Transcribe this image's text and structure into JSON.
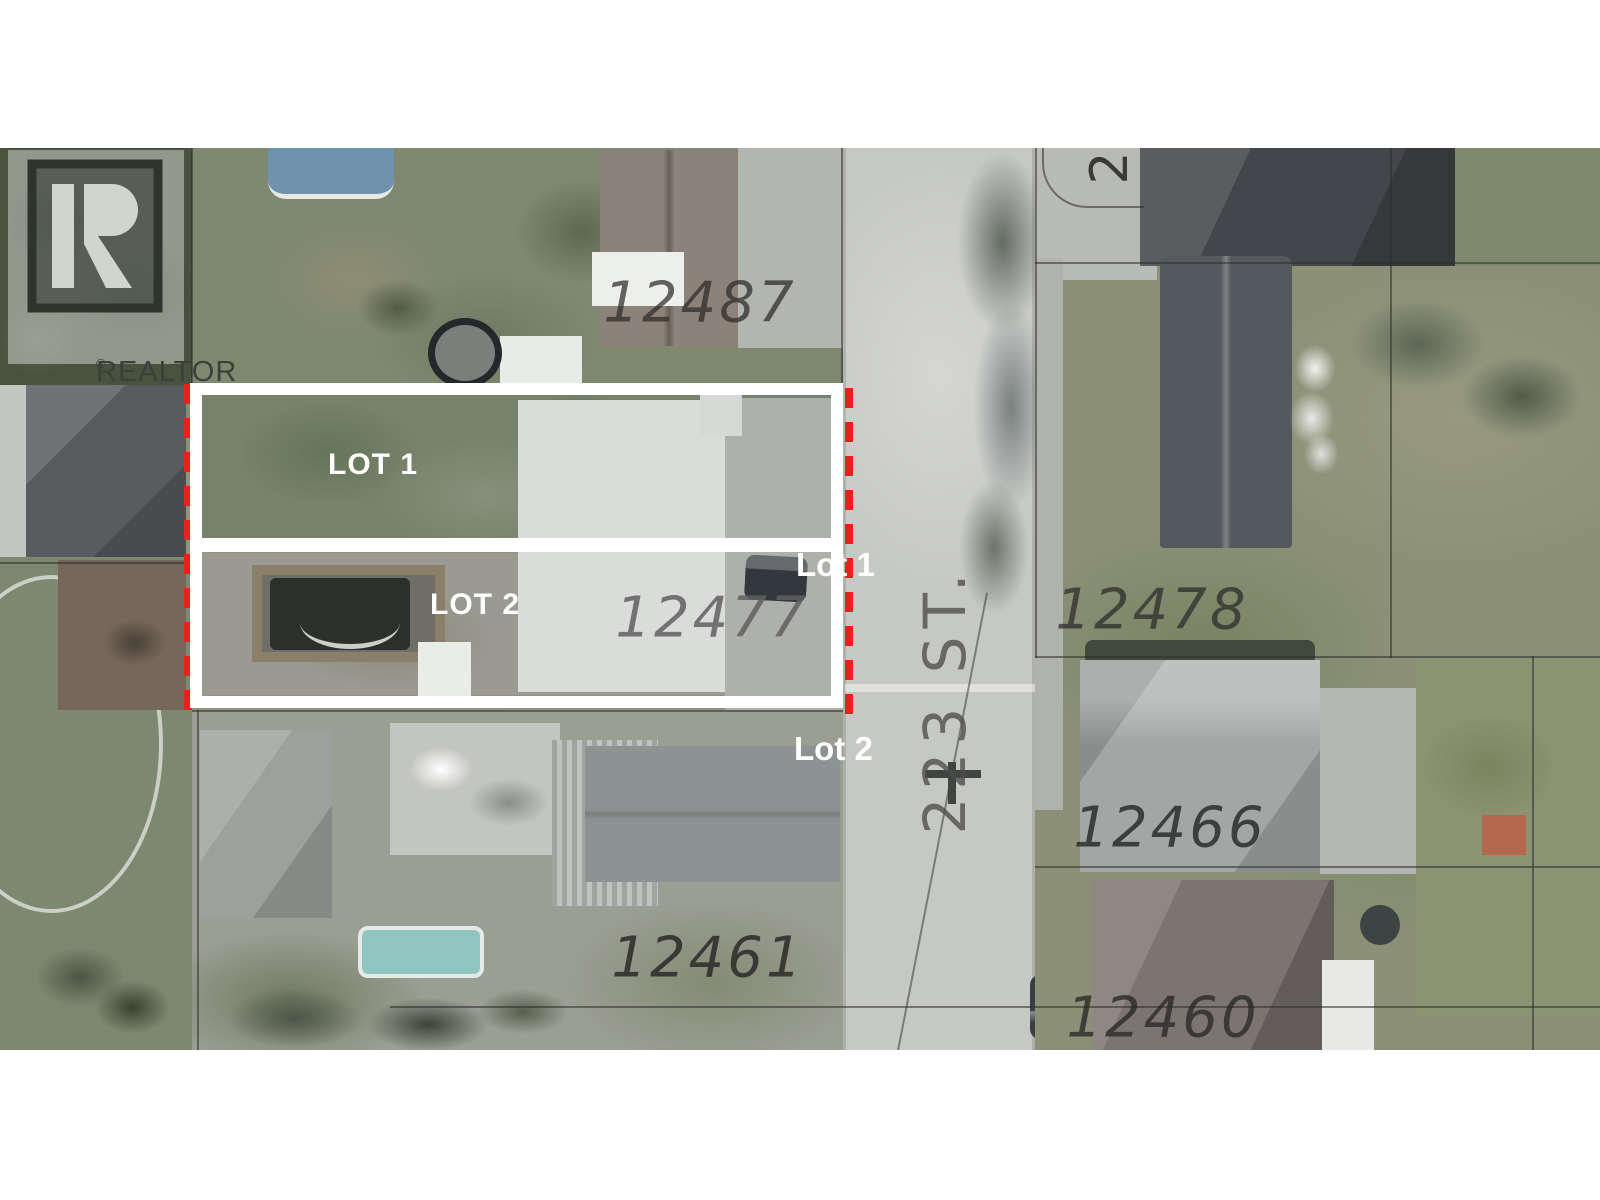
{
  "logo": {
    "r_letter": "R",
    "text": "REALTOR",
    "registered": "®"
  },
  "map": {
    "street": {
      "label": "223 ST."
    },
    "cross_number": {
      "label": "2"
    },
    "addresses": [
      {
        "id": "12487",
        "text": "12487"
      },
      {
        "id": "12478",
        "text": "12478"
      },
      {
        "id": "12477",
        "text": "12477"
      },
      {
        "id": "12466",
        "text": "12466"
      },
      {
        "id": "12461",
        "text": "12461"
      },
      {
        "id": "12460",
        "text": "12460"
      }
    ],
    "lots": {
      "lot1_inside": "LOT 1",
      "lot2_inside": "LOT 2",
      "lot1_outside": "Lot 1",
      "lot2_outside": "Lot 2"
    },
    "colors": {
      "lot_outline": "#ffffff",
      "boundary_dash": "#e8211d",
      "label_text": "#ffffff"
    }
  }
}
